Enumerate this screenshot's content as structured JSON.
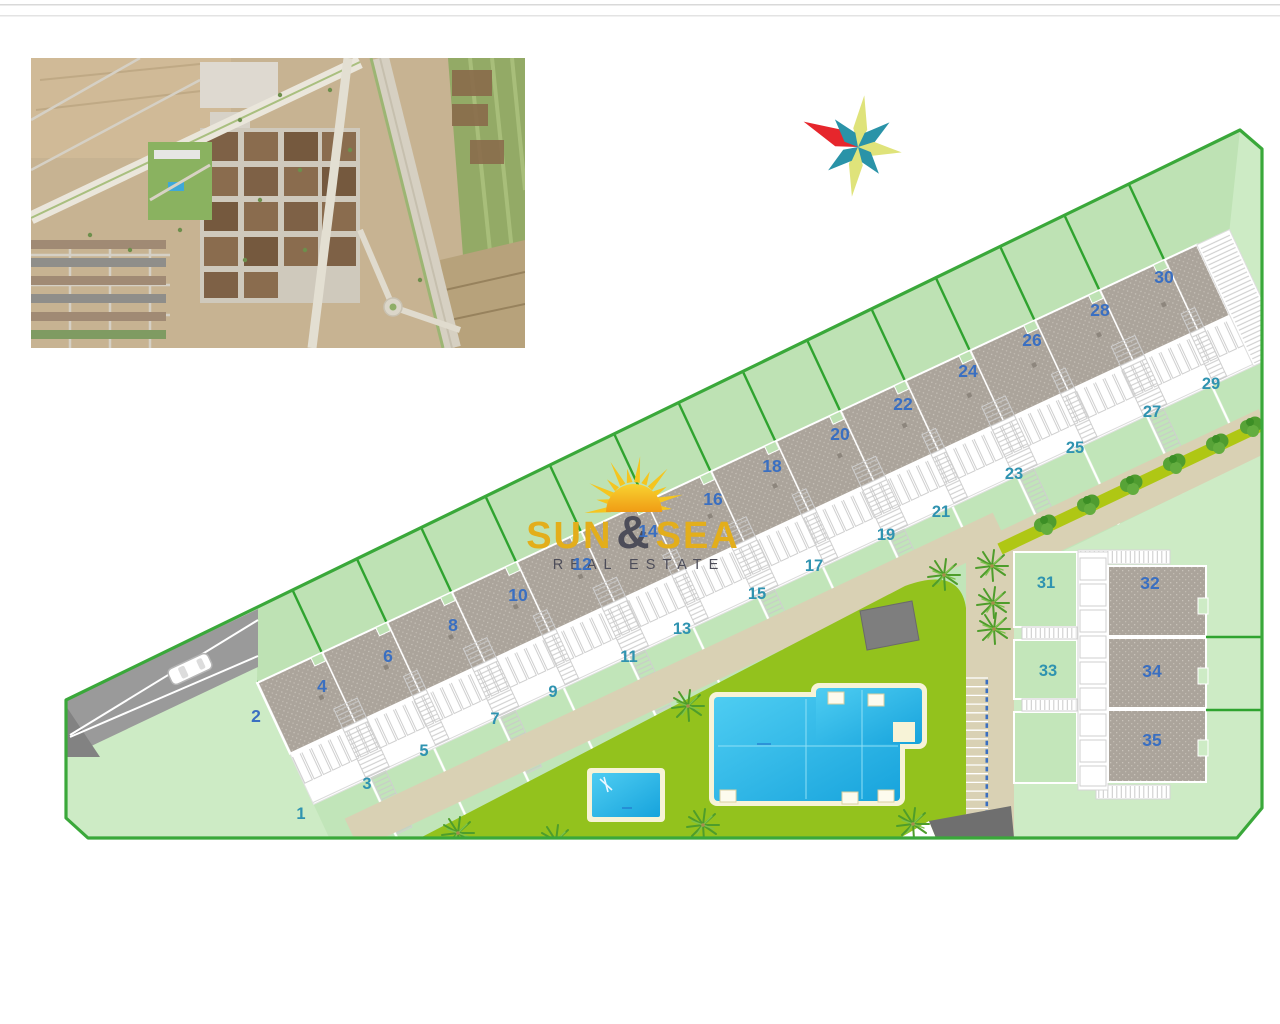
{
  "branding": {
    "logo_word_left": "SUN",
    "logo_amp": "&",
    "logo_word_right": "SEA",
    "logo_line2": "REAL ESTATE",
    "logo_yellow": "#e3ae1b",
    "logo_dark": "#4d4d59"
  },
  "icons": {
    "compass_rose": "8-point-star",
    "sun_logo": "rising-sun-with-rays"
  },
  "site_plan": {
    "plots": [
      {
        "label": "1",
        "type": "garden"
      },
      {
        "label": "2",
        "type": "roof"
      },
      {
        "label": "3",
        "type": "garden"
      },
      {
        "label": "4",
        "type": "roof"
      },
      {
        "label": "5",
        "type": "garden"
      },
      {
        "label": "6",
        "type": "roof"
      },
      {
        "label": "7",
        "type": "garden"
      },
      {
        "label": "8",
        "type": "roof"
      },
      {
        "label": "9",
        "type": "garden"
      },
      {
        "label": "10",
        "type": "roof"
      },
      {
        "label": "11",
        "type": "garden"
      },
      {
        "label": "12",
        "type": "roof"
      },
      {
        "label": "13",
        "type": "garden"
      },
      {
        "label": "14",
        "type": "roof"
      },
      {
        "label": "15",
        "type": "garden"
      },
      {
        "label": "16",
        "type": "roof"
      },
      {
        "label": "17",
        "type": "garden"
      },
      {
        "label": "18",
        "type": "roof"
      },
      {
        "label": "19",
        "type": "garden"
      },
      {
        "label": "20",
        "type": "roof"
      },
      {
        "label": "21",
        "type": "garden"
      },
      {
        "label": "22",
        "type": "roof"
      },
      {
        "label": "23",
        "type": "garden"
      },
      {
        "label": "24",
        "type": "roof"
      },
      {
        "label": "25",
        "type": "garden"
      },
      {
        "label": "26",
        "type": "roof"
      },
      {
        "label": "27",
        "type": "garden"
      },
      {
        "label": "28",
        "type": "roof"
      },
      {
        "label": "29",
        "type": "garden"
      },
      {
        "label": "30",
        "type": "roof"
      },
      {
        "label": "31",
        "type": "garden"
      },
      {
        "label": "32",
        "type": "roof"
      },
      {
        "label": "33",
        "type": "garden"
      },
      {
        "label": "34",
        "type": "roof"
      },
      {
        "label": "35",
        "type": "roof"
      }
    ],
    "colors": {
      "roof_number": "#3a6fc1",
      "garden_number": "#2f93b0",
      "boundary_green": "#3aa83a",
      "fence_green": "#2fa32f",
      "site_fill": "#cdebc5",
      "rear_garden_fill": "#bee2b4",
      "garden_fill": "#c1e5b9",
      "lawn_green": "#93c21d",
      "hedge_olive": "#afc714",
      "path_beige": "#d9d1b4",
      "roof_gray": "#aba49b",
      "driveway_gray": "#9a9a9a",
      "pool_water": "#2fc0ee",
      "pool_rim": "#f7f3d7",
      "compass_yellow": "#dfe37a",
      "compass_teal": "#2a93a8",
      "compass_red": "#e6262c"
    }
  }
}
